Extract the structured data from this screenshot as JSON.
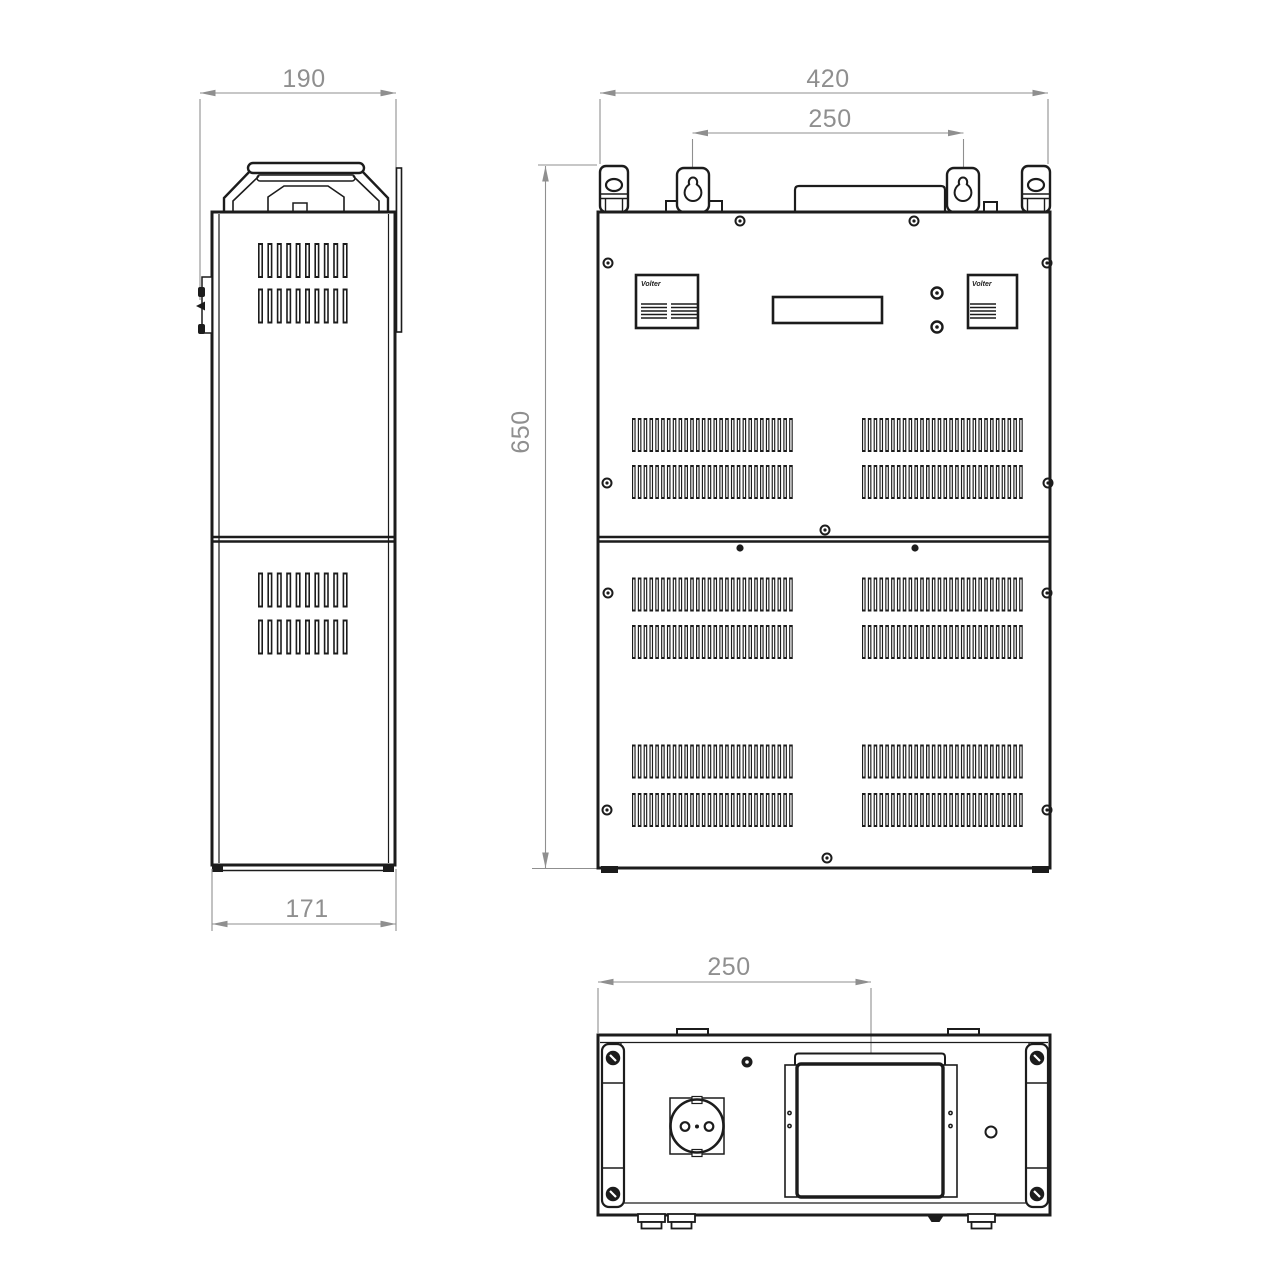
{
  "drawing": {
    "kind": "technical dimensional drawing, three views of stabilizer enclosure",
    "views": {
      "side": {
        "name": "side view",
        "dim_top_width": "190",
        "dim_bottom_depth": "171"
      },
      "front": {
        "name": "front view",
        "dim_width": "420",
        "dim_mount_spacing": "250",
        "dim_height": "650",
        "panel_logo": "Volter"
      },
      "bottom": {
        "name": "bottom view",
        "dim_plate_offset": "250"
      }
    },
    "colors": {
      "line": "#1c1c1c",
      "dimension": "#8f8f8f",
      "background": "#ffffff"
    }
  }
}
